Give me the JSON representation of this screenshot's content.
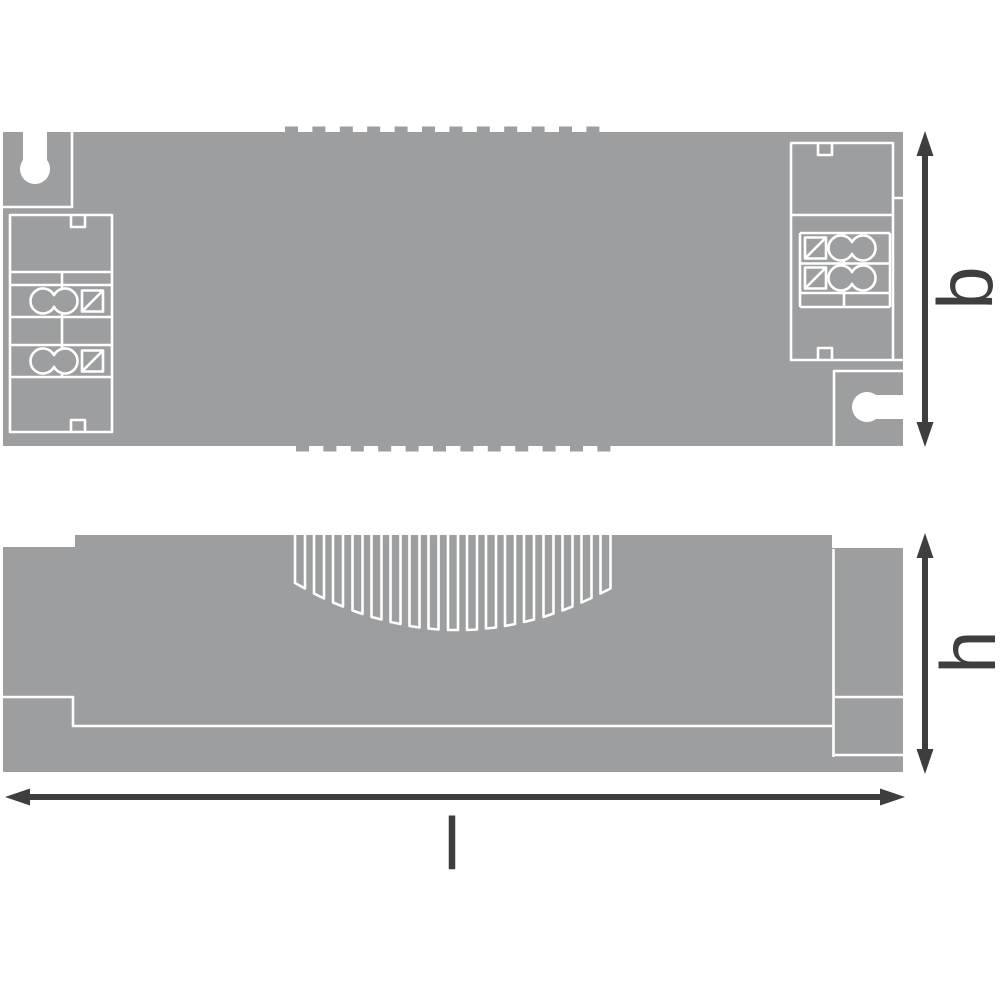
{
  "colors": {
    "background": "#ffffff",
    "body": "#9d9ea0",
    "line": "#ffffff",
    "dimension": "#3d3e40"
  },
  "dimension_labels": {
    "width": "b",
    "height": "h",
    "length": "l"
  }
}
